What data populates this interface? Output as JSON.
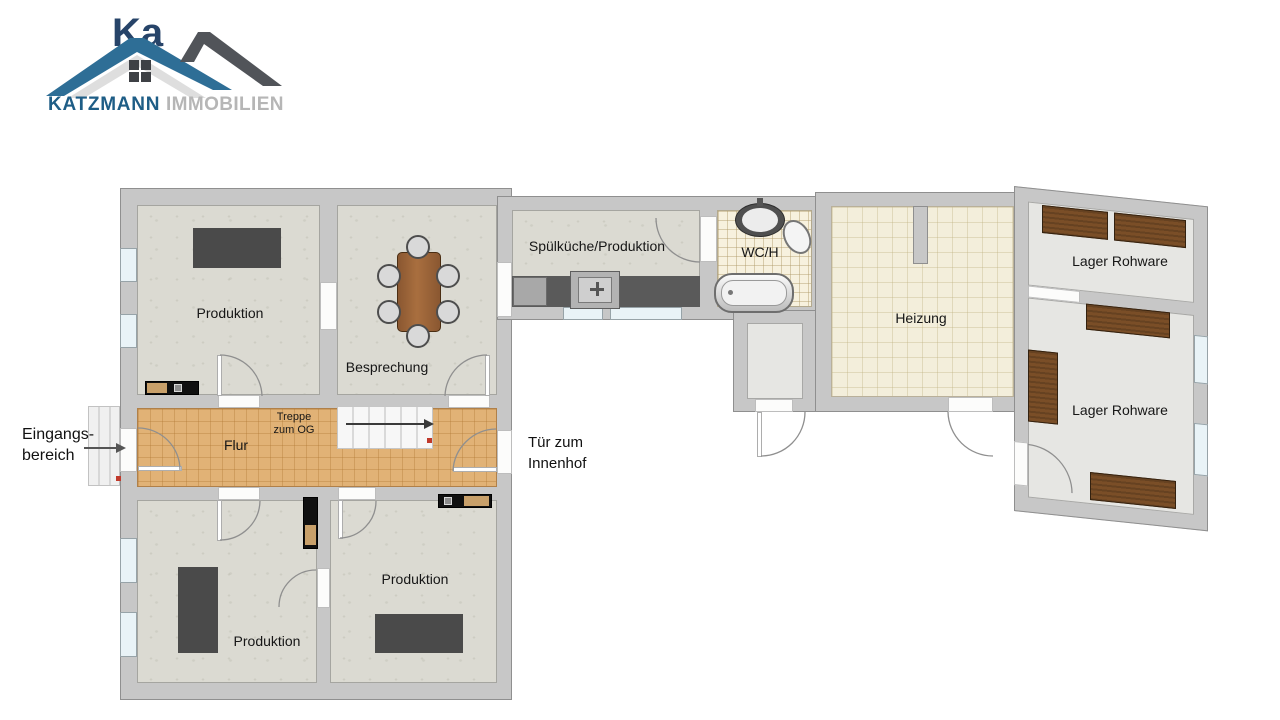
{
  "brand": {
    "watermark_fragment": "Ka",
    "name": "KATZMANN",
    "suffix": "IMMOBILIEN"
  },
  "rooms": {
    "produktion_tl": "Produktion",
    "besprechung": "Besprechung",
    "spuelkueche": "Spülküche/Produktion",
    "wc": "WC/H",
    "heizung": "Heizung",
    "lager_top": "Lager Rohware",
    "lager_bottom": "Lager Rohware",
    "flur": "Flur",
    "produktion_bl": "Produktion",
    "produktion_br": "Produktion"
  },
  "annotations": {
    "entrance_line1": "Eingangs-",
    "entrance_line2": "bereich",
    "stairs_line1": "Treppe",
    "stairs_line2": "zum OG",
    "courtyard_line1": "Tür zum",
    "courtyard_line2": "Innenhof"
  },
  "colors": {
    "wall": "#c7c7c7",
    "floor_stone": "#dbdad2",
    "floor_hall_tile": "#e1b276",
    "floor_heating_tile": "#f3eedb",
    "floor_storage": "#e6e6e3",
    "furniture_dark": "#4a4a4a",
    "wood_table": "#96613a",
    "wood_shelf": "#7a4e27",
    "brand_roof_blue": "#2e6e96",
    "brand_roof_gray": "#515459",
    "brand_text_blue": "#1e5d86",
    "brand_text_gray": "#b6b6b6",
    "marker_red": "#c0392b"
  }
}
